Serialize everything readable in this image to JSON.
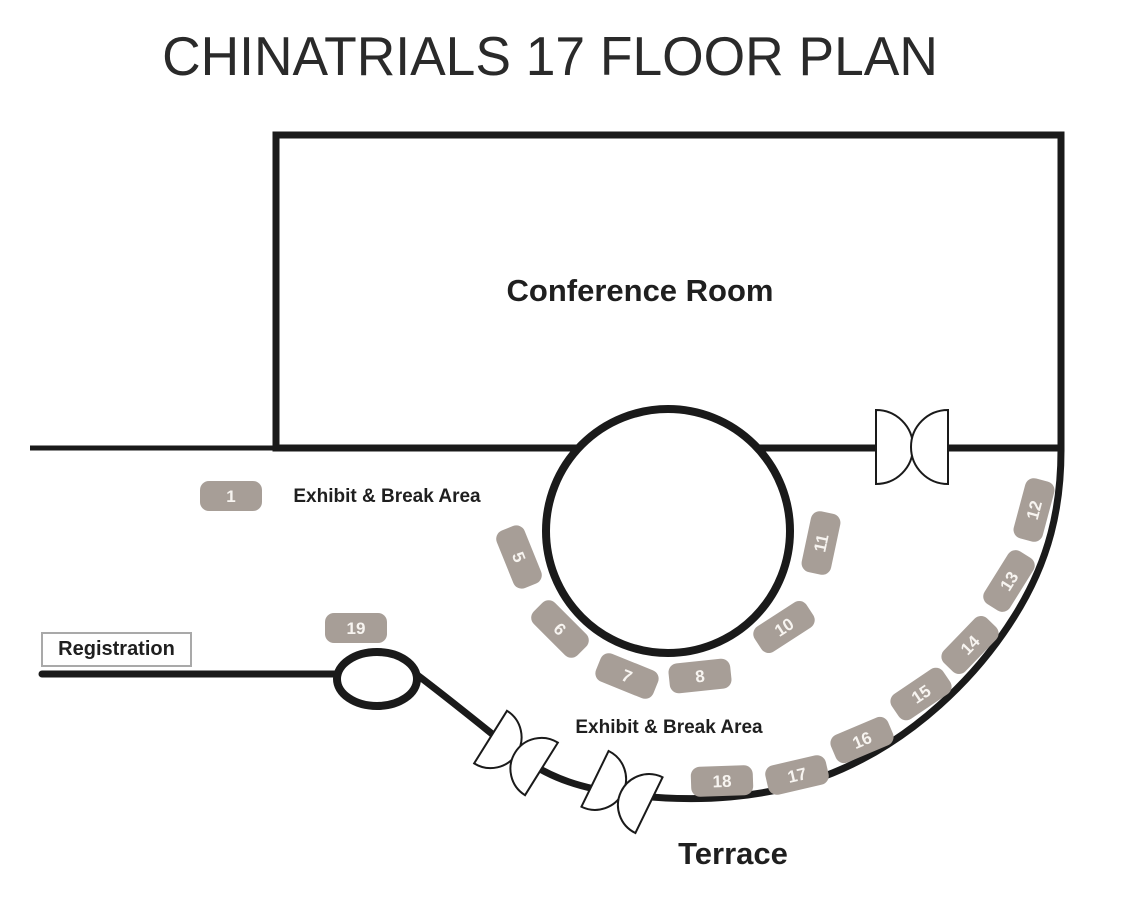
{
  "title": "CHINATRIALS 17 FLOOR PLAN",
  "labels": {
    "conference_room": "Conference Room",
    "exhibit_break_top": "Exhibit & Break Area",
    "exhibit_break_bottom": "Exhibit & Break Area",
    "terrace": "Terrace",
    "registration": "Registration"
  },
  "booths": [
    {
      "label": "1"
    },
    {
      "label": "5"
    },
    {
      "label": "6"
    },
    {
      "label": "7"
    },
    {
      "label": "8"
    },
    {
      "label": "10"
    },
    {
      "label": "11"
    },
    {
      "label": "12"
    },
    {
      "label": "13"
    },
    {
      "label": "14"
    },
    {
      "label": "15"
    },
    {
      "label": "16"
    },
    {
      "label": "17"
    },
    {
      "label": "18"
    },
    {
      "label": "19"
    }
  ],
  "colors": {
    "wall": "#1a1a1a",
    "booth_fill": "#a79e97",
    "booth_text": "#f7f4f0",
    "background": "#ffffff"
  }
}
